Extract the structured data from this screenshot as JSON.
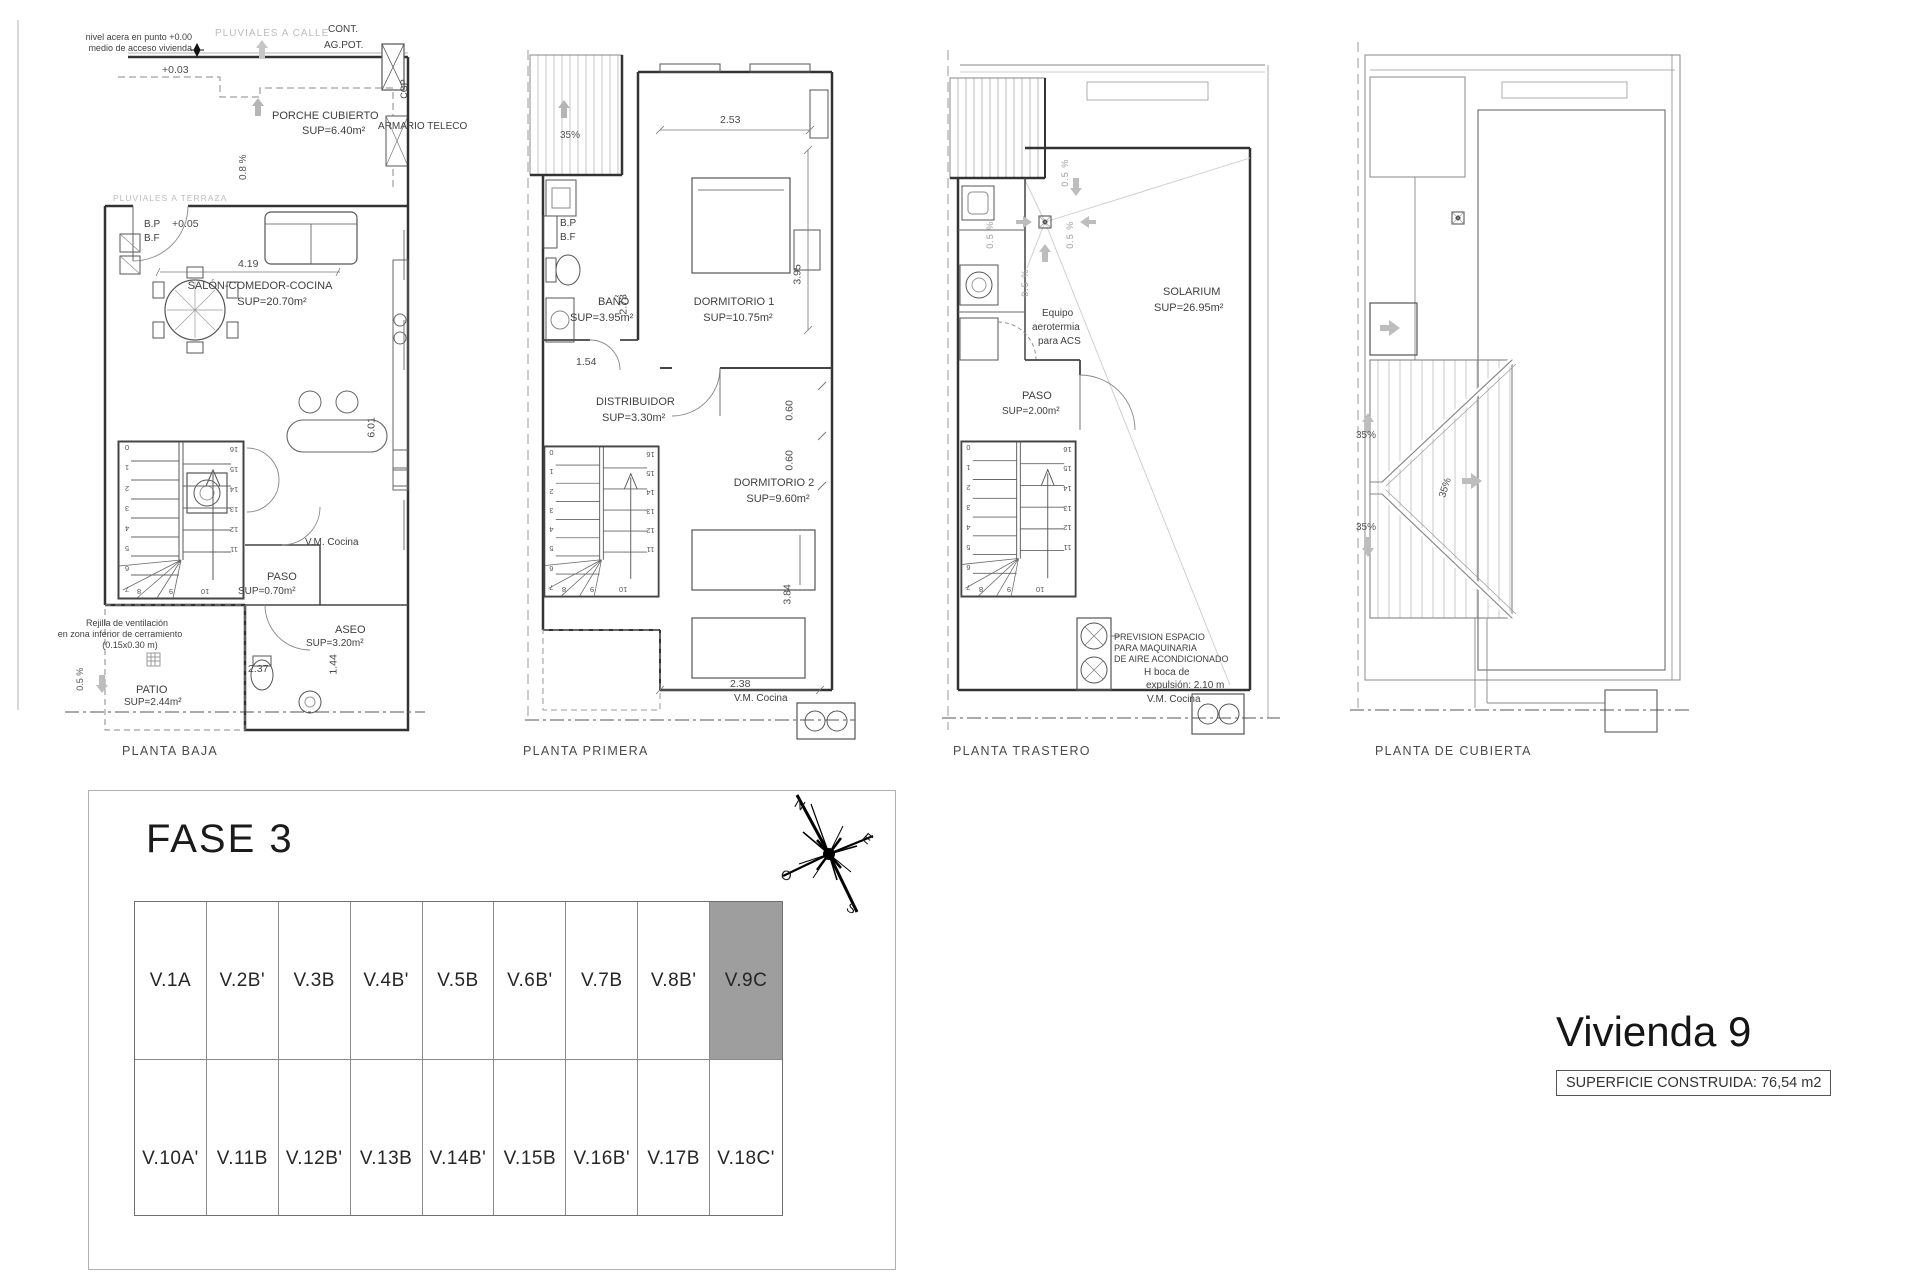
{
  "plans": {
    "baja": {
      "title": "PLANTA BAJA",
      "ann": {
        "nivel1": "nivel acera en punto +0.00",
        "nivel2": "medio de acceso vivienda",
        "pluviales_calle": "PLUVIALES A CALLE",
        "cont": "CONT.",
        "agpot": "AG.POT.",
        "c003": "+0.03",
        "cgp": "CGP",
        "armario": "ARMARIO TELECO",
        "slope08": "0.8 %",
        "pluviales_terraza": "PLUVIALES A TERRAZA",
        "bp": "B.P",
        "bf": "B.F",
        "c005": "+0.05",
        "vm": "V.M. Cocina",
        "rejilla1": "Rejilla de ventilación",
        "rejilla2": "en zona inferior de cerramiento",
        "rejilla3": "(0.15x0.30 m)",
        "slope05": "0.5 %"
      },
      "rooms": {
        "porche": {
          "n": "PORCHE CUBIERTO",
          "a": "SUP=6.40m²"
        },
        "salon": {
          "n": "SALÓN-COMEDOR-COCINA",
          "a": "SUP=20.70m²"
        },
        "paso": {
          "n": "PASO",
          "a": "SUP=0.70m²"
        },
        "aseo": {
          "n": "ASEO",
          "a": "SUP=3.20m²"
        },
        "patio": {
          "n": "PATIO",
          "a": "SUP=2.44m²"
        }
      },
      "dims": {
        "w": "4.19",
        "h": "6.01",
        "aseo_w": "2.37",
        "aseo_h": "1.44"
      }
    },
    "primera": {
      "title": "PLANTA PRIMERA",
      "ann": {
        "slope35": "35%",
        "bp": "B.P",
        "bf": "B.F",
        "vm": "V.M. Cocina"
      },
      "rooms": {
        "bano": {
          "n": "BAÑO",
          "a": "SUP=3.95m²"
        },
        "dorm1": {
          "n": "DORMITORIO 1",
          "a": "SUP=10.75m²"
        },
        "dist": {
          "n": "DISTRIBUIDOR",
          "a": "SUP=3.30m²"
        },
        "dorm2": {
          "n": "DORMITORIO 2",
          "a": "SUP=9.60m²"
        }
      },
      "dims": {
        "d253": "2.53",
        "d395": "3.95",
        "d273": "2.73",
        "d154": "1.54",
        "d060a": "0.60",
        "d060b": "0.60",
        "d384": "3.84",
        "d238": "2.38"
      }
    },
    "trastero": {
      "title": "PLANTA TRASTERO",
      "ann": {
        "slope05": "0.5 %",
        "equipo1": "Equipo",
        "equipo2": "aerotermia",
        "equipo3": "para ACS",
        "prev1": "PREVISION ESPACIO",
        "prev2": "PARA MAQUINARIA",
        "prev3": "DE AIRE ACONDICIONADO",
        "boca1": "H boca de",
        "boca2": "expulsión: 2.10 m",
        "vm": "V.M. Cocina"
      },
      "rooms": {
        "solarium": {
          "n": "SOLARIUM",
          "a": "SUP=26.95m²"
        },
        "paso": {
          "n": "PASO",
          "a": "SUP=2.00m²"
        }
      }
    },
    "cubierta": {
      "title": "PLANTA DE CUBIERTA",
      "ann": {
        "slope35": "35%"
      }
    }
  },
  "stairs": {
    "left": [
      "0",
      "1",
      "2",
      "3",
      "4",
      "5",
      "6",
      "7"
    ],
    "right": [
      "16",
      "15",
      "14",
      "13",
      "12",
      "11"
    ],
    "bottom": [
      "8",
      "9",
      "10"
    ]
  },
  "fase3": {
    "title": "FASE 3",
    "compass": {
      "n": "N",
      "e": "E",
      "o": "O",
      "s": "S"
    },
    "row1": [
      "V.1A",
      "V.2B'",
      "V.3B",
      "V.4B'",
      "V.5B",
      "V.6B'",
      "V.7B",
      "V.8B'",
      "V.9C"
    ],
    "row2": [
      "V.10A'",
      "V.11B",
      "V.12B'",
      "V.13B",
      "V.14B'",
      "V.15B",
      "V.16B'",
      "V.17B",
      "V.18C'"
    ],
    "highlight": "V.9C",
    "highlight_color": "#9e9e9e"
  },
  "summary": {
    "title": "Vivienda 9",
    "superficie": "SUPERFICIE CONSTRUIDA: 76,54 m2"
  }
}
